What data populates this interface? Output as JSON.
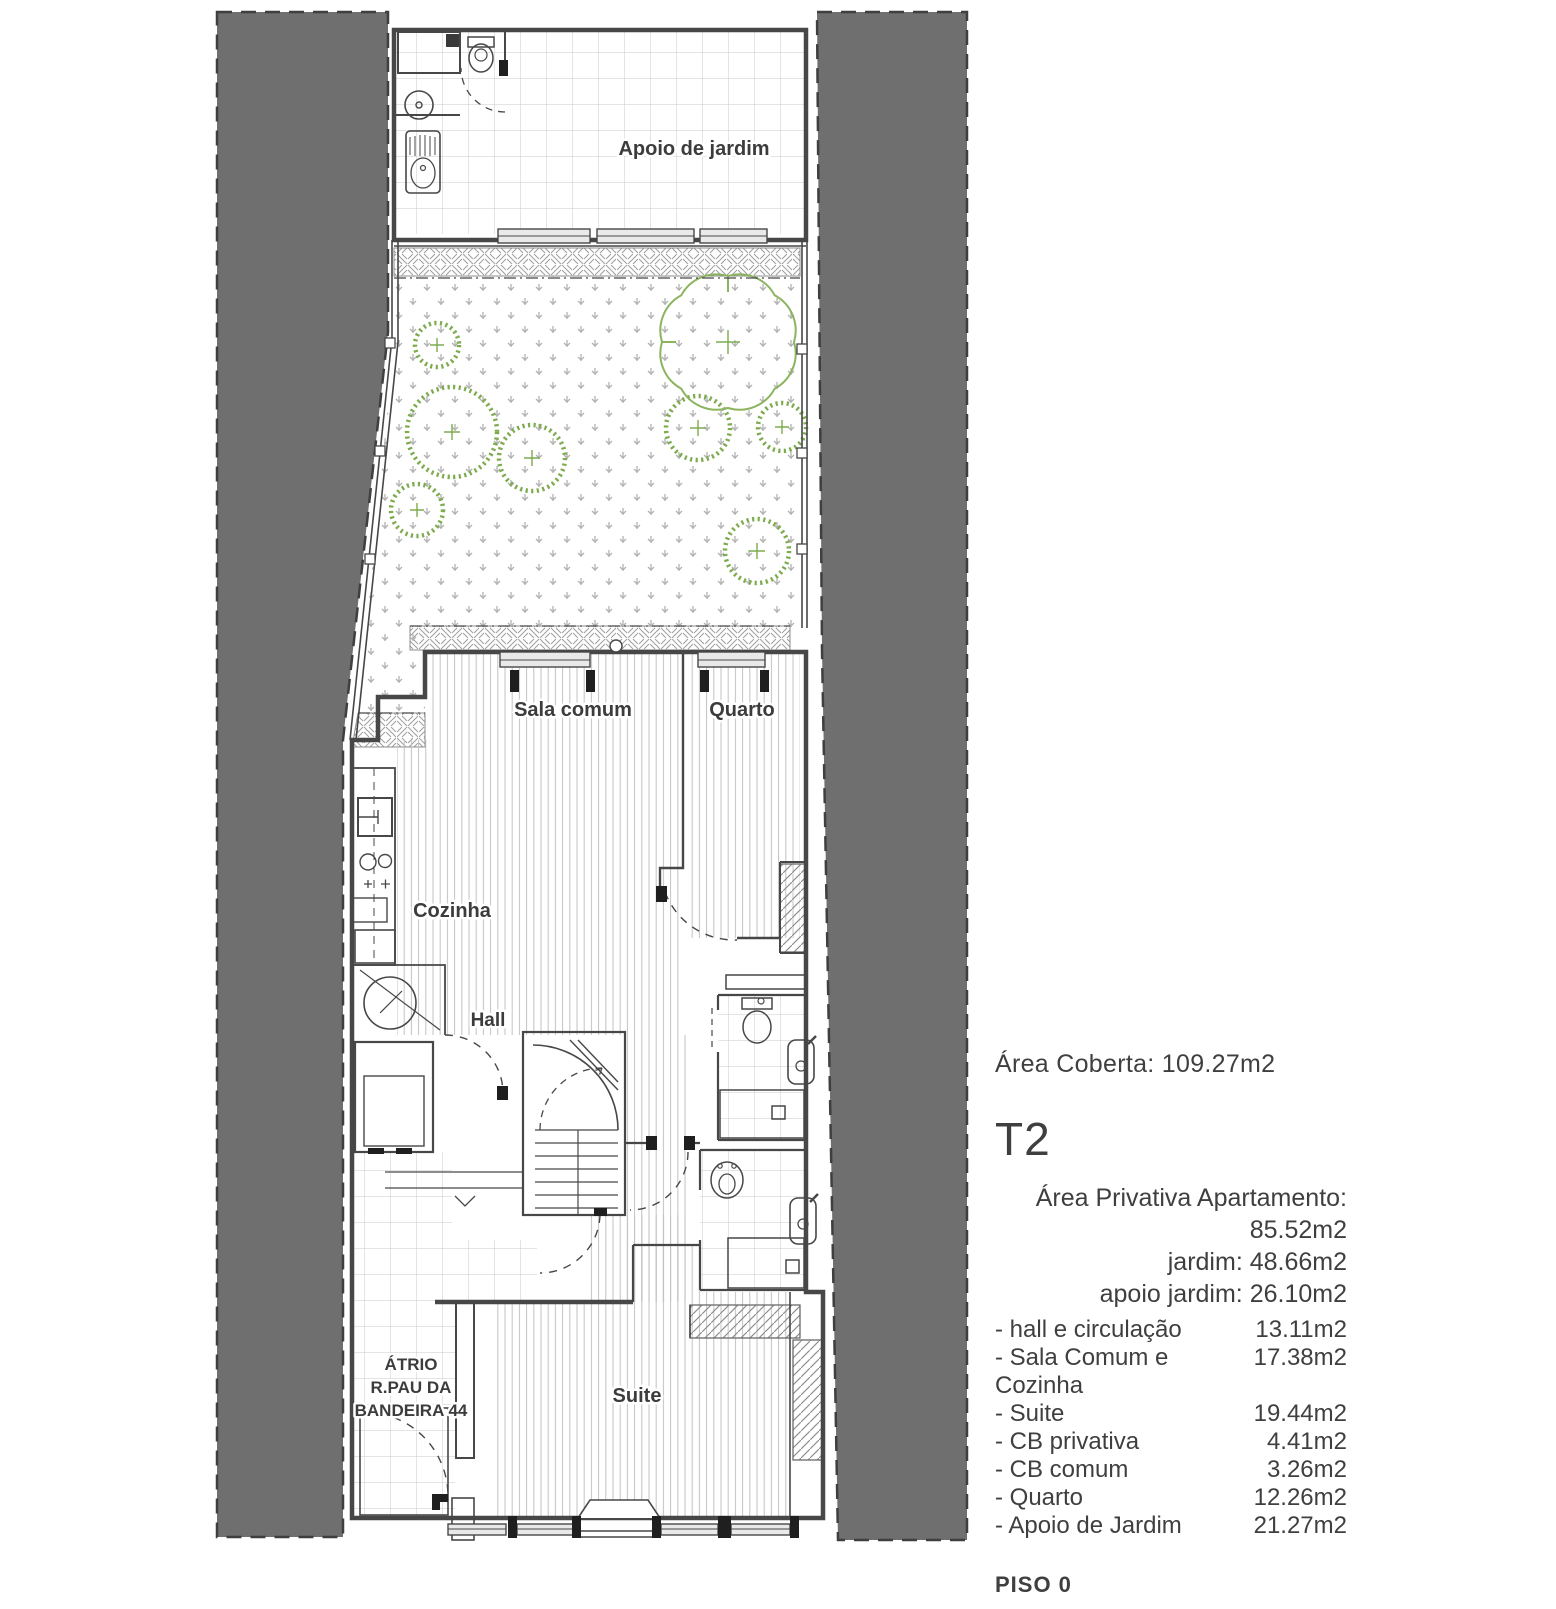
{
  "plan": {
    "labels": {
      "apoio": "Apoio de jardim",
      "sala": "Sala comum",
      "quarto": "Quarto",
      "cozinha": "Cozinha",
      "hall": "Hall",
      "suite": "Suite"
    },
    "atrium_lines": [
      "ÁTRIO",
      "R.PAU DA",
      "BANDEIRA 44"
    ],
    "colors": {
      "neighbor_gray": "#6f6f6f",
      "wall_line": "#474747",
      "shrub_green": "#7dab4e",
      "tree_green": "#8cb45e",
      "pattern_gray": "#c7c7c7"
    }
  },
  "panel": {
    "area_coberta": "Área Coberta: 109.27m2",
    "unit_type": "T2",
    "private_lines": [
      "Área Privativa Apartamento: 85.52m2",
      "jardim: 48.66m2",
      "apoio jardim:  26.10m2"
    ],
    "room_areas": [
      {
        "label": "- hall e circulação",
        "value": "13.11m2"
      },
      {
        "label": "- Sala Comum e Cozinha",
        "value": "17.38m2"
      },
      {
        "label": "- Suite",
        "value": "19.44m2"
      },
      {
        "label": "- CB privativa",
        "value": "4.41m2"
      },
      {
        "label": "- CB comum",
        "value": "3.26m2"
      },
      {
        "label": "- Quarto",
        "value": "12.26m2"
      },
      {
        "label": "- Apoio de Jardim",
        "value": "21.27m2"
      }
    ],
    "floor_label": "PISO 0"
  }
}
